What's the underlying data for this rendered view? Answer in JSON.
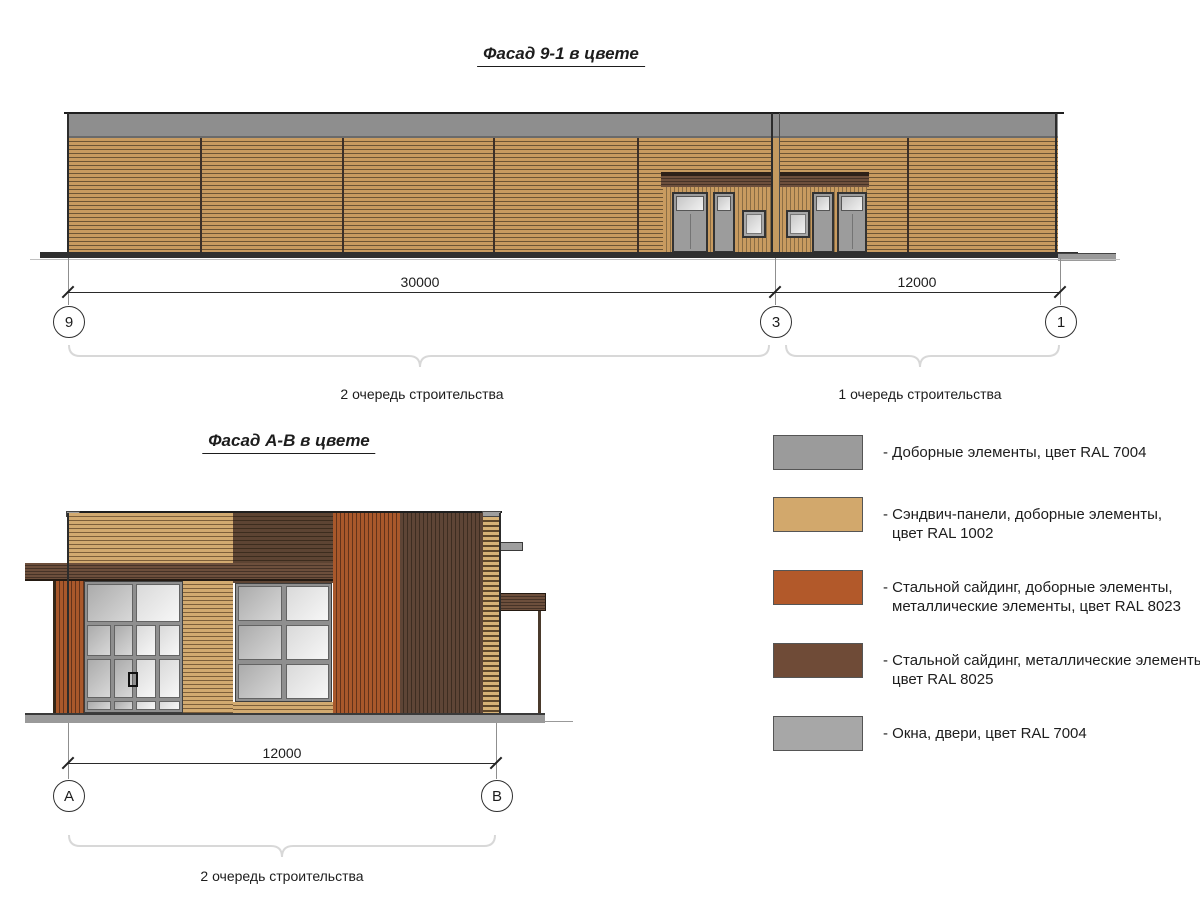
{
  "titles": {
    "facade1": "Фасад 9-1 в цвете",
    "facade2": "Фасад А-В в цвете"
  },
  "facade1": {
    "dim_left": "30000",
    "dim_right": "12000",
    "axes": {
      "left": "9",
      "middle": "3",
      "right": "1"
    },
    "phase_left": "2 очередь строительства",
    "phase_right": "1 очередь строительства"
  },
  "facade2": {
    "dim": "12000",
    "axes": {
      "left": "А",
      "right": "В"
    },
    "phase": "2 очередь строительства"
  },
  "legend": {
    "items": [
      {
        "color": "#9b9b9b",
        "label": "- Доборные элементы, цвет RAL 7004"
      },
      {
        "color": "#d2a86c",
        "label": "- Сэндвич-панели, доборные элементы,\nцвет RAL 1002"
      },
      {
        "color": "#b2592a",
        "label": "- Стальной сайдинг, доборные элементы,\nметаллические элементы, цвет RAL 8023"
      },
      {
        "color": "#6f4b37",
        "label": "- Стальной сайдинг, металлические элементы,\nцвет RAL 8025"
      },
      {
        "color": "#a7a7a7",
        "label": "- Окна, двери, цвет RAL 7004"
      }
    ]
  }
}
